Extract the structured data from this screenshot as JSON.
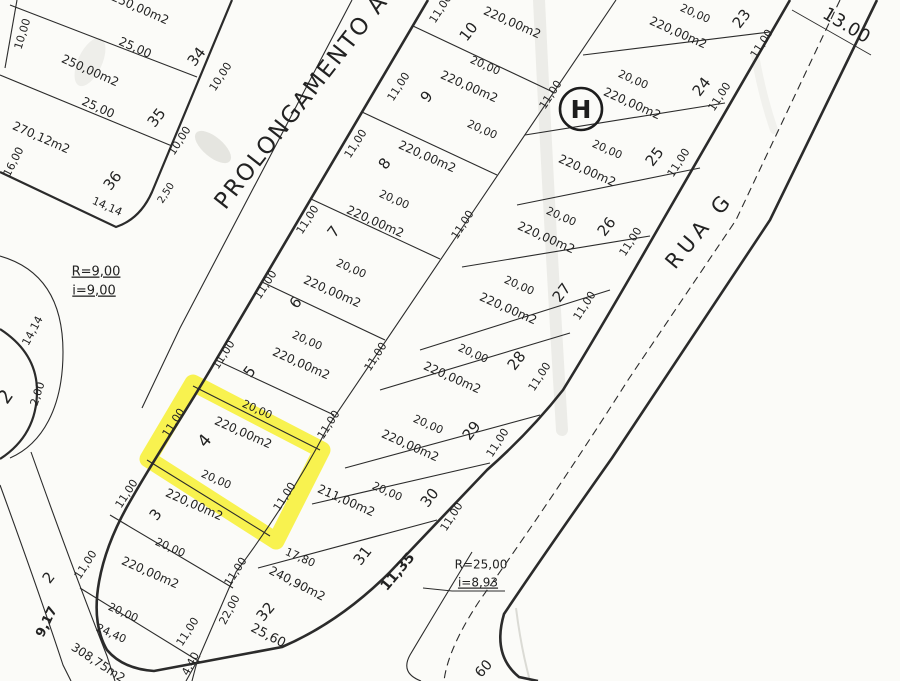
{
  "map": {
    "paper_color": "#fbfbf8",
    "ink_color": "#2b2b2b",
    "highlight_color": "#f6ef2a",
    "h_marker": {
      "text": "H"
    },
    "street_names": {
      "prolongamento": "PROLONGAMENTO A",
      "rua_g": "RUA G"
    },
    "curve_notes": {
      "r9": "R=9,00",
      "i9": "i=9,00",
      "r25": "R=25,00",
      "i893": "i=8,93"
    },
    "labels": [
      {
        "n": "street-name-prolongamento-a",
        "t": "PROLONGAMENTO A",
        "x": 302,
        "y": 102,
        "r": -52,
        "s": 23,
        "ls": 2,
        "w": 500
      },
      {
        "n": "street-name-rua-g",
        "t": "RUA G",
        "x": 700,
        "y": 231,
        "r": -50,
        "s": 21,
        "ls": 5,
        "w": 500
      },
      {
        "n": "dim-rua-g-width",
        "t": "13.00",
        "x": 846,
        "y": 26,
        "r": 31,
        "s": 18,
        "w": 500
      },
      {
        "n": "note-curve-r9",
        "t": "R=9,00",
        "x": 96,
        "y": 272,
        "r": 0,
        "s": 13,
        "u": true
      },
      {
        "n": "note-curve-i9",
        "t": "i=9,00",
        "x": 94,
        "y": 291,
        "r": 0,
        "s": 13,
        "u": true
      },
      {
        "n": "note-curve-r25",
        "t": "R=25,00",
        "x": 481,
        "y": 565,
        "r": 0,
        "s": 12
      },
      {
        "n": "note-curve-i893",
        "t": "i=8,93",
        "x": 478,
        "y": 583,
        "r": 0,
        "s": 12,
        "u": true
      },
      {
        "n": "dim-60-partial",
        "t": "60",
        "x": 484,
        "y": 669,
        "r": -48,
        "s": 14
      },
      {
        "n": "dim-2-50",
        "t": "2,50",
        "x": 166,
        "y": 193,
        "r": -57,
        "s": 10
      },
      {
        "n": "dim-14-14-block-a",
        "t": "14,14",
        "x": 107,
        "y": 207,
        "r": 24,
        "s": 11
      },
      {
        "n": "dim-14-14-corner",
        "t": "14,14",
        "x": 33,
        "y": 331,
        "r": -62,
        "s": 11
      },
      {
        "n": "dim-2-00",
        "t": "2,00",
        "x": 38,
        "y": 394,
        "r": -72,
        "s": 11
      },
      {
        "n": "lot-number-partial-2",
        "t": "2",
        "x": 6,
        "y": 397,
        "r": -55,
        "s": 19
      },
      {
        "n": "dim-9-17",
        "t": "9,17",
        "x": 47,
        "y": 622,
        "r": -64,
        "s": 13,
        "w": 600
      },
      {
        "n": "lot-1-area",
        "t": "308,75m2",
        "x": 98,
        "y": 663,
        "r": 33,
        "s": 12
      },
      {
        "n": "lot-34-area",
        "t": "250,00m2",
        "x": 140,
        "y": 9,
        "r": 24,
        "s": 12
      },
      {
        "n": "lot-34-depth",
        "t": "25,00",
        "x": 135,
        "y": 48,
        "r": 24,
        "s": 12
      },
      {
        "n": "lot-34-number",
        "t": "34",
        "x": 197,
        "y": 57,
        "r": -52,
        "s": 15
      },
      {
        "n": "lot-34-frontage-west",
        "t": "10,00",
        "x": 23,
        "y": 34,
        "r": -73,
        "s": 11
      },
      {
        "n": "lot-34-frontage-east",
        "t": "10,00",
        "x": 221,
        "y": 77,
        "r": -57,
        "s": 11
      },
      {
        "n": "lot-35-area",
        "t": "250,00m2",
        "x": 90,
        "y": 71,
        "r": 24,
        "s": 12
      },
      {
        "n": "lot-35-depth",
        "t": "25,00",
        "x": 98,
        "y": 108,
        "r": 24,
        "s": 12
      },
      {
        "n": "lot-35-number",
        "t": "35",
        "x": 157,
        "y": 118,
        "r": -52,
        "s": 15
      },
      {
        "n": "lot-35-frontage",
        "t": "10,00",
        "x": 180,
        "y": 141,
        "r": -57,
        "s": 11
      },
      {
        "n": "lot-36-area",
        "t": "270,12m2",
        "x": 41,
        "y": 138,
        "r": 24,
        "s": 12
      },
      {
        "n": "dim-16-00",
        "t": "16,00",
        "x": 14,
        "y": 162,
        "r": -63,
        "s": 11
      },
      {
        "n": "lot-36-number",
        "t": "36",
        "x": 113,
        "y": 181,
        "r": -52,
        "s": 15
      },
      {
        "n": "lot-10-frontage",
        "t": "11,00",
        "x": 441,
        "y": 9,
        "r": -57,
        "s": 11
      },
      {
        "n": "lot-10-number",
        "t": "10",
        "x": 469,
        "y": 32,
        "r": -52,
        "s": 15
      },
      {
        "n": "lot-10-area",
        "t": "220,00m2",
        "x": 512,
        "y": 23,
        "r": 24,
        "s": 12
      },
      {
        "n": "lot-10-depth",
        "t": "20,00",
        "x": 485,
        "y": 66,
        "r": 24,
        "s": 11
      },
      {
        "n": "lot-9-frontage",
        "t": "11,00",
        "x": 399,
        "y": 87,
        "r": -57,
        "s": 11
      },
      {
        "n": "lot-9-number",
        "t": "9",
        "x": 427,
        "y": 97,
        "r": -52,
        "s": 15
      },
      {
        "n": "lot-9-area",
        "t": "220,00m2",
        "x": 469,
        "y": 87,
        "r": 24,
        "s": 12
      },
      {
        "n": "lot-9-depth",
        "t": "20,00",
        "x": 482,
        "y": 130,
        "r": 24,
        "s": 11
      },
      {
        "n": "lot-8-frontage",
        "t": "11,00",
        "x": 356,
        "y": 144,
        "r": -57,
        "s": 11
      },
      {
        "n": "lot-8-number",
        "t": "8",
        "x": 385,
        "y": 164,
        "r": -52,
        "s": 15
      },
      {
        "n": "lot-8-area",
        "t": "220,00m2",
        "x": 427,
        "y": 157,
        "r": 24,
        "s": 12
      },
      {
        "n": "lot-8-depth",
        "t": "20,00",
        "x": 394,
        "y": 200,
        "r": 24,
        "s": 11
      },
      {
        "n": "lot-7-frontage",
        "t": "11,00",
        "x": 308,
        "y": 220,
        "r": -57,
        "s": 11
      },
      {
        "n": "lot-7-number",
        "t": "7",
        "x": 334,
        "y": 232,
        "r": -52,
        "s": 15
      },
      {
        "n": "lot-7-area",
        "t": "220,00m2",
        "x": 375,
        "y": 222,
        "r": 24,
        "s": 12
      },
      {
        "n": "lot-7-depth",
        "t": "20,00",
        "x": 351,
        "y": 269,
        "r": 24,
        "s": 11
      },
      {
        "n": "lot-6-frontage",
        "t": "11,00",
        "x": 266,
        "y": 285,
        "r": -57,
        "s": 11
      },
      {
        "n": "lot-6-number",
        "t": "6",
        "x": 296,
        "y": 303,
        "r": -52,
        "s": 15
      },
      {
        "n": "lot-6-area",
        "t": "220,00m2",
        "x": 332,
        "y": 292,
        "r": 24,
        "s": 12
      },
      {
        "n": "lot-6-depth",
        "t": "20,00",
        "x": 307,
        "y": 341,
        "r": 24,
        "s": 11
      },
      {
        "n": "lot-5-frontage",
        "t": "11,00",
        "x": 224,
        "y": 355,
        "r": -57,
        "s": 11
      },
      {
        "n": "lot-5-number",
        "t": "5",
        "x": 250,
        "y": 372,
        "r": -52,
        "s": 15
      },
      {
        "n": "lot-5-area",
        "t": "220,00m2",
        "x": 301,
        "y": 364,
        "r": 24,
        "s": 12
      },
      {
        "n": "lot-5-depth",
        "t": "20,00",
        "x": 257,
        "y": 410,
        "r": 24,
        "s": 11
      },
      {
        "n": "lot-4-frontage",
        "t": "11,00",
        "x": 174,
        "y": 423,
        "r": -57,
        "s": 11
      },
      {
        "n": "lot-4-number",
        "t": "4",
        "x": 205,
        "y": 441,
        "r": -50,
        "s": 17
      },
      {
        "n": "lot-4-area",
        "t": "220,00m2",
        "x": 243,
        "y": 433,
        "r": 24,
        "s": 12
      },
      {
        "n": "lot-4-depth",
        "t": "20,00",
        "x": 216,
        "y": 480,
        "r": 24,
        "s": 11
      },
      {
        "n": "lot-4-rear",
        "t": "11,00",
        "x": 285,
        "y": 497,
        "r": -57,
        "s": 11
      },
      {
        "n": "lot-3-frontage",
        "t": "11,00",
        "x": 127,
        "y": 494,
        "r": -57,
        "s": 11
      },
      {
        "n": "lot-3-number",
        "t": "3",
        "x": 156,
        "y": 515,
        "r": -52,
        "s": 15
      },
      {
        "n": "lot-3-area",
        "t": "220,00m2",
        "x": 194,
        "y": 505,
        "r": 24,
        "s": 12
      },
      {
        "n": "lot-3-depth",
        "t": "20,00",
        "x": 170,
        "y": 548,
        "r": 24,
        "s": 11
      },
      {
        "n": "lot-2-frontage",
        "t": "11,00",
        "x": 86,
        "y": 565,
        "r": -57,
        "s": 11
      },
      {
        "n": "lot-2-number",
        "t": "2",
        "x": 49,
        "y": 578,
        "r": -52,
        "s": 15
      },
      {
        "n": "lot-2-area",
        "t": "220,00m2",
        "x": 150,
        "y": 573,
        "r": 24,
        "s": 12
      },
      {
        "n": "lot-2-depth",
        "t": "20,00",
        "x": 123,
        "y": 613,
        "r": 24,
        "s": 11
      },
      {
        "n": "dim-24-40",
        "t": "24,40",
        "x": 111,
        "y": 634,
        "r": 24,
        "s": 11
      },
      {
        "n": "rear-dim-11-00-a",
        "t": "11,00",
        "x": 551,
        "y": 95,
        "r": -57,
        "s": 11
      },
      {
        "n": "rear-dim-11-00-b",
        "t": "11,00",
        "x": 463,
        "y": 225,
        "r": -57,
        "s": 11
      },
      {
        "n": "rear-dim-11-00-c",
        "t": "11,00",
        "x": 376,
        "y": 357,
        "r": -57,
        "s": 11
      },
      {
        "n": "rear-dim-11-00-d",
        "t": "11,00",
        "x": 329,
        "y": 425,
        "r": -57,
        "s": 11
      },
      {
        "n": "lot-23-depth",
        "t": "20,00",
        "x": 695,
        "y": 14,
        "r": 24,
        "s": 11
      },
      {
        "n": "lot-23-number",
        "t": "23",
        "x": 742,
        "y": 19,
        "r": -52,
        "s": 15
      },
      {
        "n": "lot-23-area",
        "t": "220,00m2",
        "x": 678,
        "y": 33,
        "r": 24,
        "s": 12
      },
      {
        "n": "lot-23-frontage",
        "t": "11,00",
        "x": 762,
        "y": 44,
        "r": -57,
        "s": 11
      },
      {
        "n": "lot-24-depth",
        "t": "20,00",
        "x": 633,
        "y": 80,
        "r": 24,
        "s": 11
      },
      {
        "n": "lot-24-number",
        "t": "24",
        "x": 702,
        "y": 87,
        "r": -52,
        "s": 15
      },
      {
        "n": "lot-24-area",
        "t": "220,00m2",
        "x": 632,
        "y": 104,
        "r": 24,
        "s": 12
      },
      {
        "n": "lot-24-frontage",
        "t": "11,00",
        "x": 720,
        "y": 97,
        "r": -57,
        "s": 11
      },
      {
        "n": "lot-25-depth",
        "t": "20,00",
        "x": 607,
        "y": 150,
        "r": 24,
        "s": 11
      },
      {
        "n": "lot-25-number",
        "t": "25",
        "x": 655,
        "y": 157,
        "r": -52,
        "s": 15
      },
      {
        "n": "lot-25-area",
        "t": "220,00m2",
        "x": 587,
        "y": 171,
        "r": 24,
        "s": 12
      },
      {
        "n": "lot-25-frontage",
        "t": "11,00",
        "x": 679,
        "y": 163,
        "r": -57,
        "s": 11
      },
      {
        "n": "lot-26-depth",
        "t": "20,00",
        "x": 561,
        "y": 217,
        "r": 24,
        "s": 11
      },
      {
        "n": "lot-26-number",
        "t": "26",
        "x": 607,
        "y": 227,
        "r": -52,
        "s": 15
      },
      {
        "n": "lot-26-area",
        "t": "220,00m2",
        "x": 546,
        "y": 238,
        "r": 24,
        "s": 12
      },
      {
        "n": "lot-26-frontage",
        "t": "11,00",
        "x": 631,
        "y": 242,
        "r": -57,
        "s": 11
      },
      {
        "n": "lot-27-depth",
        "t": "20,00",
        "x": 519,
        "y": 286,
        "r": 24,
        "s": 11
      },
      {
        "n": "lot-27-number",
        "t": "27",
        "x": 562,
        "y": 293,
        "r": -52,
        "s": 15
      },
      {
        "n": "lot-27-area",
        "t": "220,00m2",
        "x": 508,
        "y": 309,
        "r": 24,
        "s": 12
      },
      {
        "n": "lot-27-frontage",
        "t": "11,00",
        "x": 585,
        "y": 306,
        "r": -57,
        "s": 11
      },
      {
        "n": "lot-28-depth",
        "t": "20,00",
        "x": 473,
        "y": 354,
        "r": 24,
        "s": 11
      },
      {
        "n": "lot-28-number",
        "t": "28",
        "x": 517,
        "y": 361,
        "r": -52,
        "s": 15
      },
      {
        "n": "lot-28-area",
        "t": "220,00m2",
        "x": 452,
        "y": 378,
        "r": 24,
        "s": 12
      },
      {
        "n": "lot-28-frontage",
        "t": "11,00",
        "x": 540,
        "y": 377,
        "r": -57,
        "s": 11
      },
      {
        "n": "lot-29-depth",
        "t": "20,00",
        "x": 428,
        "y": 425,
        "r": 24,
        "s": 11
      },
      {
        "n": "lot-29-number",
        "t": "29",
        "x": 472,
        "y": 431,
        "r": -52,
        "s": 15
      },
      {
        "n": "lot-29-area",
        "t": "220,00m2",
        "x": 410,
        "y": 446,
        "r": 24,
        "s": 12
      },
      {
        "n": "lot-29-frontage",
        "t": "11,00",
        "x": 498,
        "y": 443,
        "r": -57,
        "s": 11
      },
      {
        "n": "lot-30-depth",
        "t": "20,00",
        "x": 387,
        "y": 492,
        "r": 24,
        "s": 11
      },
      {
        "n": "lot-30-number",
        "t": "30",
        "x": 430,
        "y": 498,
        "r": -52,
        "s": 15
      },
      {
        "n": "lot-30-frontage",
        "t": "11,00",
        "x": 452,
        "y": 517,
        "r": -57,
        "s": 11
      },
      {
        "n": "lot-31-area",
        "t": "211,00m2",
        "x": 346,
        "y": 501,
        "r": 24,
        "s": 12
      },
      {
        "n": "lot-31-number",
        "t": "31",
        "x": 363,
        "y": 556,
        "r": -52,
        "s": 15
      },
      {
        "n": "lot-31-frontage",
        "t": "11,35",
        "x": 398,
        "y": 572,
        "r": -50,
        "s": 14,
        "w": 600
      },
      {
        "n": "dim-17-80",
        "t": "17,80",
        "x": 300,
        "y": 558,
        "r": 24,
        "s": 11
      },
      {
        "n": "lot-32-area",
        "t": "240,90m2",
        "x": 297,
        "y": 584,
        "r": 27,
        "s": 12
      },
      {
        "n": "lot-32-number",
        "t": "32",
        "x": 266,
        "y": 612,
        "r": -50,
        "s": 15
      },
      {
        "n": "dim-22-00",
        "t": "22,00",
        "x": 230,
        "y": 610,
        "r": -62,
        "s": 11
      },
      {
        "n": "dim-25-60",
        "t": "25,60",
        "x": 268,
        "y": 636,
        "r": 27,
        "s": 13
      },
      {
        "n": "dim-11-00-lot32-rear",
        "t": "11,00",
        "x": 236,
        "y": 572,
        "r": -57,
        "s": 11
      },
      {
        "n": "dim-11-00-lot1",
        "t": "11,00",
        "x": 188,
        "y": 632,
        "r": -57,
        "s": 11
      },
      {
        "n": "dim-4-40",
        "t": "4,40",
        "x": 191,
        "y": 664,
        "r": -62,
        "s": 11
      }
    ]
  }
}
